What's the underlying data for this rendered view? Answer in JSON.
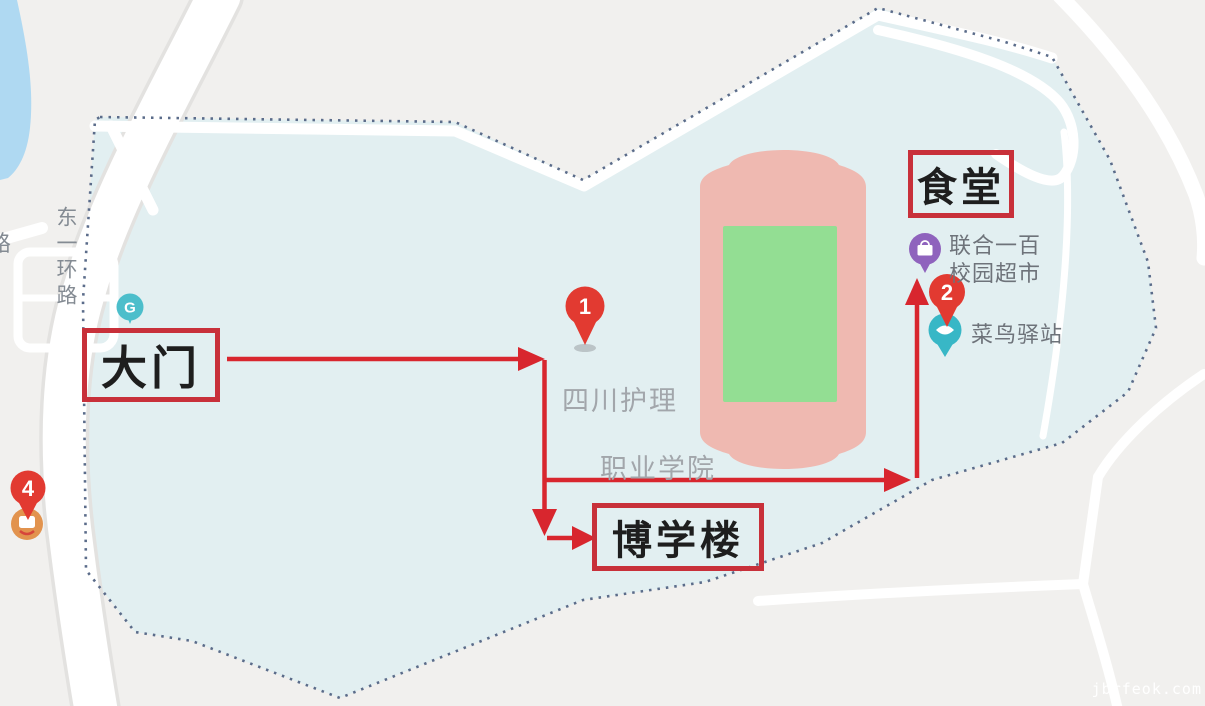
{
  "map": {
    "campus_name": {
      "line1": "四川护理",
      "line2": "职业学院"
    },
    "road_label": "东一环路",
    "road_label_partial": "路",
    "annotation_labels": {
      "gate": "大门",
      "canteen": "食堂",
      "boxue_building": "博学楼"
    },
    "poi_labels": {
      "supermarket_line1": "联合一百",
      "supermarket_line2": "校园超市",
      "cainiao_station": "菜鸟驿站"
    },
    "pin_numbers": {
      "pin1": "1",
      "pin2": "2",
      "pin4": "4"
    },
    "gate_marker_glyph": "G",
    "watermark": "jbrfeok.com",
    "colors": {
      "annotation_red": "#D8262E",
      "label_box_border": "#C8303A",
      "campus_fill": "#E2EFF1",
      "outside_fill": "#F1F0EE",
      "boundary_dash": "#5B6C8A",
      "water": "#AFD9F2",
      "road": "#FFFFFF",
      "track_pink": "#EFB9B1",
      "field_green": "#93DE93",
      "pin_red": "#E23A31",
      "pin_teal": "#38B7C6",
      "pin_purple": "#8F63BD",
      "marker_orange": "#E2934E",
      "gate_marker_teal": "#4CBECB",
      "map_text_gray": "#9BA2A8"
    }
  }
}
